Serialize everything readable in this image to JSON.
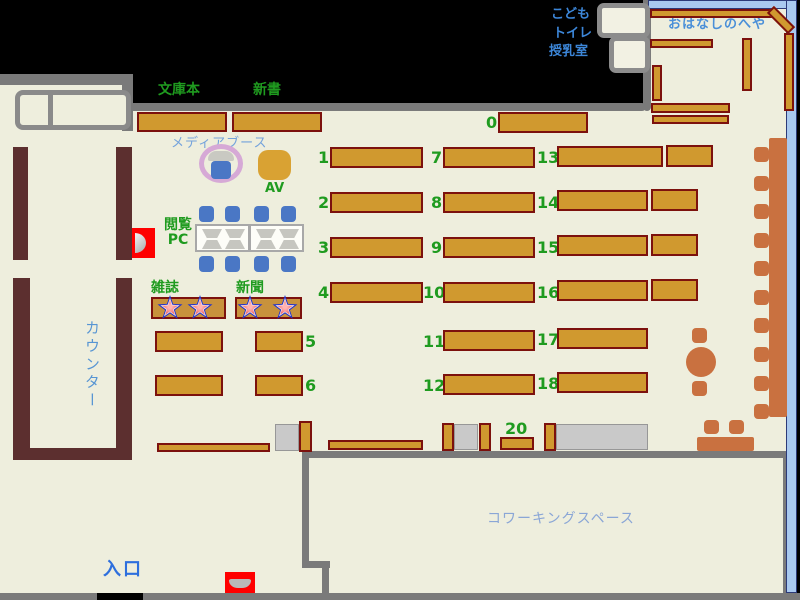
{
  "title": "図書館フロアマップ",
  "labels": {
    "bunkobon": "文庫本",
    "shinsho": "新書",
    "media_booth": "メディアブース",
    "av": "AV",
    "browsing_pc_line1": "閲覧",
    "browsing_pc_line2": "PC",
    "magazines": "雑誌",
    "newspapers": "新聞",
    "counter": "カウンター",
    "entrance": "入口",
    "coworking_space": "コワーキングスペース",
    "kids": "こども",
    "toilet": "トイレ",
    "nursing_room": "授乳室",
    "story_room": "おはなしのへや"
  },
  "shelf_numbers": {
    "top": "0",
    "col1": [
      "1",
      "2",
      "3",
      "4",
      "5",
      "6"
    ],
    "col2": [
      "7",
      "8",
      "9",
      "10",
      "11",
      "12"
    ],
    "col3": [
      "13",
      "14",
      "15",
      "16",
      "17",
      "18"
    ],
    "standalone": "20"
  },
  "colors": {
    "background": "#000000",
    "floor": "#eeeedd",
    "wall_gray": "#7a7a7a",
    "counter_maroon": "#5c2f2f",
    "shelf_fill": "#d0992f",
    "shelf_border": "#7c110d",
    "furniture_orange": "#c97140",
    "chair_blue": "#4a77c5",
    "story_room_wall_blue": "#a9c9ef",
    "label_green": "#1f9b1f",
    "label_blue": "#3c86d8",
    "entrance_blue": "#2e6fdd",
    "alert_red": "#ff0000",
    "media_ring_purple": "#d6a9d6",
    "star_blue": "#2233cc",
    "star_pink": "#f07070"
  }
}
